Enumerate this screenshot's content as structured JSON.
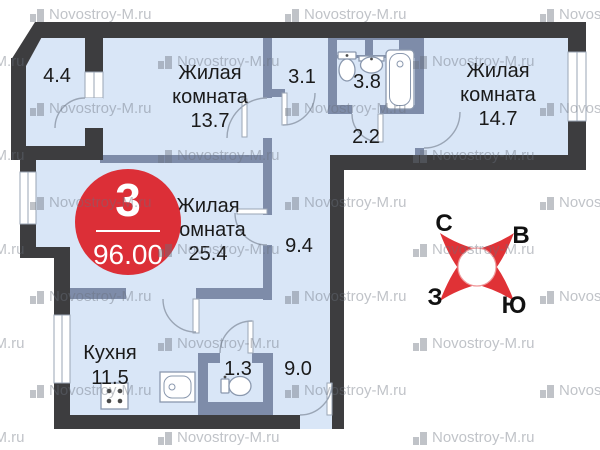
{
  "watermark": {
    "text": "Novostroy-M.ru"
  },
  "badge": {
    "rooms_count": "3",
    "area_total": "96.00"
  },
  "compass": {
    "n": "С",
    "e": "В",
    "w": "З",
    "s": "Ю"
  },
  "rooms": {
    "balcony": {
      "area": "4.4"
    },
    "living_top": {
      "line1": "Жилая",
      "line2": "комната",
      "area": "13.7"
    },
    "hall_top": {
      "area": "3.1"
    },
    "bathroom": {
      "area": "3.8"
    },
    "corridor": {
      "area": "2.2"
    },
    "living_right": {
      "line1": "Жилая",
      "line2": "комната",
      "area": "14.7"
    },
    "living_main": {
      "line1": "Жилая",
      "line2": "комната",
      "area": "25.4"
    },
    "hall_middle": {
      "area": "9.4"
    },
    "kitchen": {
      "name": "Кухня",
      "area": "11.5"
    },
    "wc": {
      "area": "1.3"
    },
    "hall_entry": {
      "area": "9.0"
    }
  },
  "colors": {
    "floor": "#d9e6f7",
    "wall_exterior": "#3d3d3f",
    "wall_interior": "#7e8ca9",
    "badge_red": "#dc2f37",
    "compass_red": "#e03236"
  }
}
